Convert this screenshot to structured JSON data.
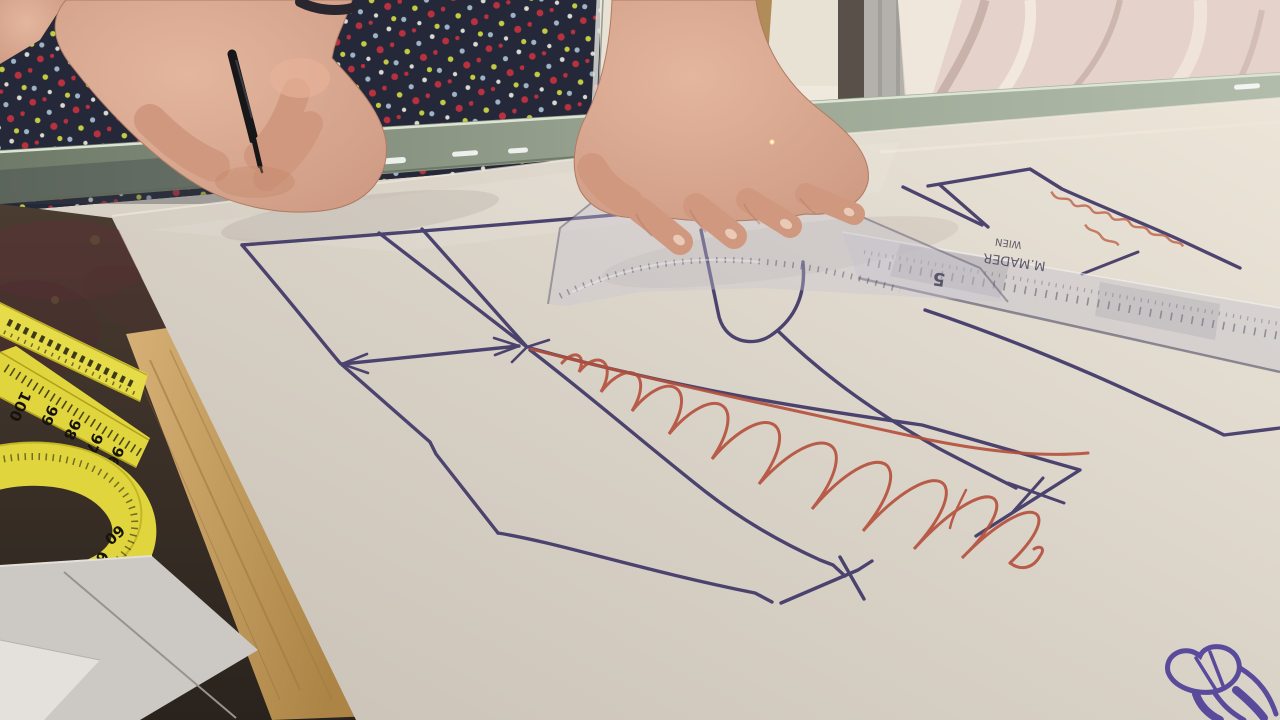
{
  "photo": {
    "alt": "Dressmaker's hands drafting sewing pattern pieces in navy and red marker on pattern paper over a glass counter, with a yellow measuring tape, transparent tailor's ruler, hanging blush fabric and a floral dress in the background"
  },
  "measuring_tape": {
    "upper_numbers": [
      "100",
      "99",
      "98",
      "97",
      "96"
    ],
    "loop_numbers": [
      "64",
      "63",
      "62",
      "61",
      "60"
    ]
  },
  "ruler": {
    "size_digit": "5",
    "brand": "M.MADER",
    "city": "WIEN"
  },
  "colors": {
    "paper": "#d8d1c6",
    "navy_marker": "#443c6a",
    "red_marker": "#b5503c",
    "purple_marker": "#5a4a9c",
    "tape_yellow": "#e0d53c",
    "wood": "#c2a066",
    "skin": "#d6a48e",
    "dress_navy": "#242838",
    "blush_fabric": "#e5d2ca",
    "glass_edge": "#8f9c8d"
  }
}
